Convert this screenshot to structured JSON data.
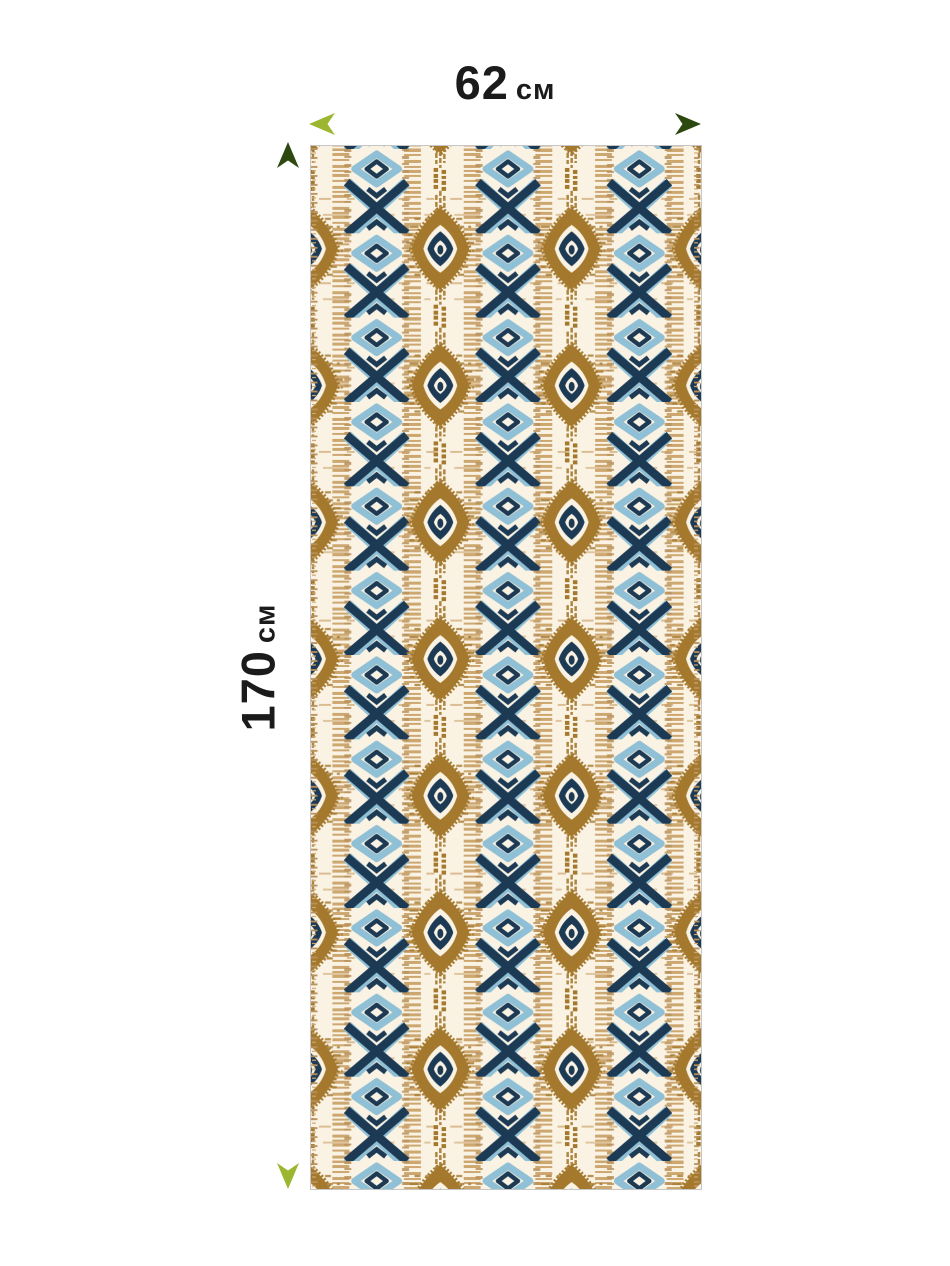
{
  "illustration": {
    "subject": "ikat-fabric-swatch",
    "type": "product-dimensions"
  },
  "dimensions": {
    "width": {
      "value": "62",
      "unit": "см"
    },
    "height": {
      "value": "170",
      "unit": "см"
    }
  },
  "colors": {
    "page_bg": "#ffffff",
    "text": "#1b1b1b",
    "cream": "#faf2e3",
    "blue": "#8fc0d5",
    "navy": "#1d3a55",
    "brown": "#a4792e",
    "tan": "#cda770",
    "tan2": "#b8905a",
    "border": "#c6c6c6",
    "arrow_light": "#9cb72f",
    "arrow_dark": "#2c490f"
  }
}
